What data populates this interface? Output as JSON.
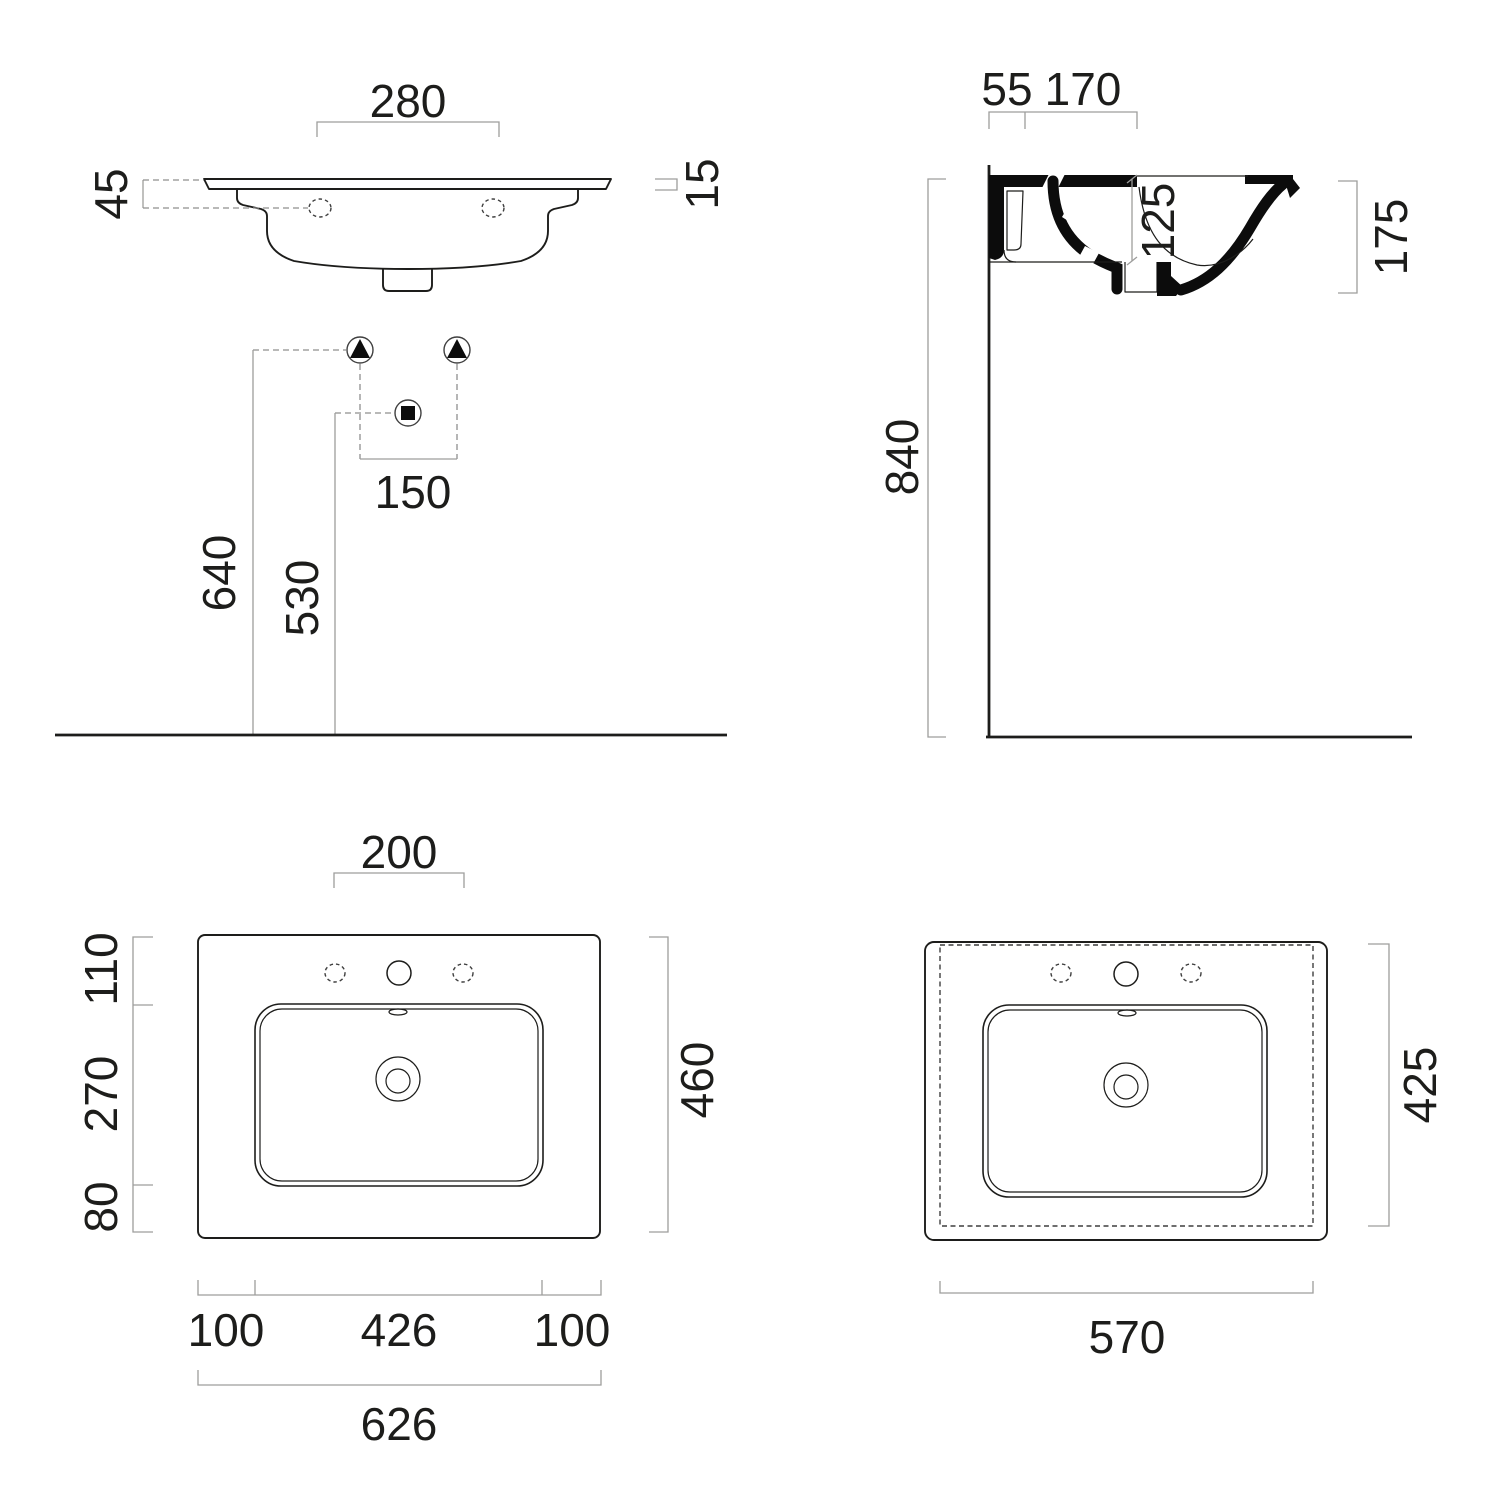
{
  "drawing": {
    "type": "washbasin-technical-drawing",
    "background": "#ffffff",
    "line_color": "#1d1d1b",
    "dim_color": "#9d9d9c",
    "views": {
      "front": {
        "label": "front-elevation",
        "dims": {
          "tap_span": "280",
          "rim_drop": "45",
          "rim_thickness": "15",
          "fixing_height": "640",
          "drain_height": "530",
          "fixing_span": "150"
        }
      },
      "side": {
        "label": "side-section",
        "dims": {
          "wall_offset": "55",
          "deck_depth": "170",
          "bowl_depth": "125",
          "apron_height": "175",
          "mount_height": "840"
        }
      },
      "plan": {
        "label": "top-plan",
        "dims": {
          "faucet_span": "200",
          "back_strip": "110",
          "bowl_depth": "270",
          "front_strip": "80",
          "total_depth": "460",
          "left_offset": "100",
          "bowl_width": "426",
          "right_offset": "100",
          "total_width": "626"
        }
      },
      "underside": {
        "label": "bottom-underside",
        "dims": {
          "base_depth": "425",
          "base_width": "570"
        }
      }
    }
  }
}
